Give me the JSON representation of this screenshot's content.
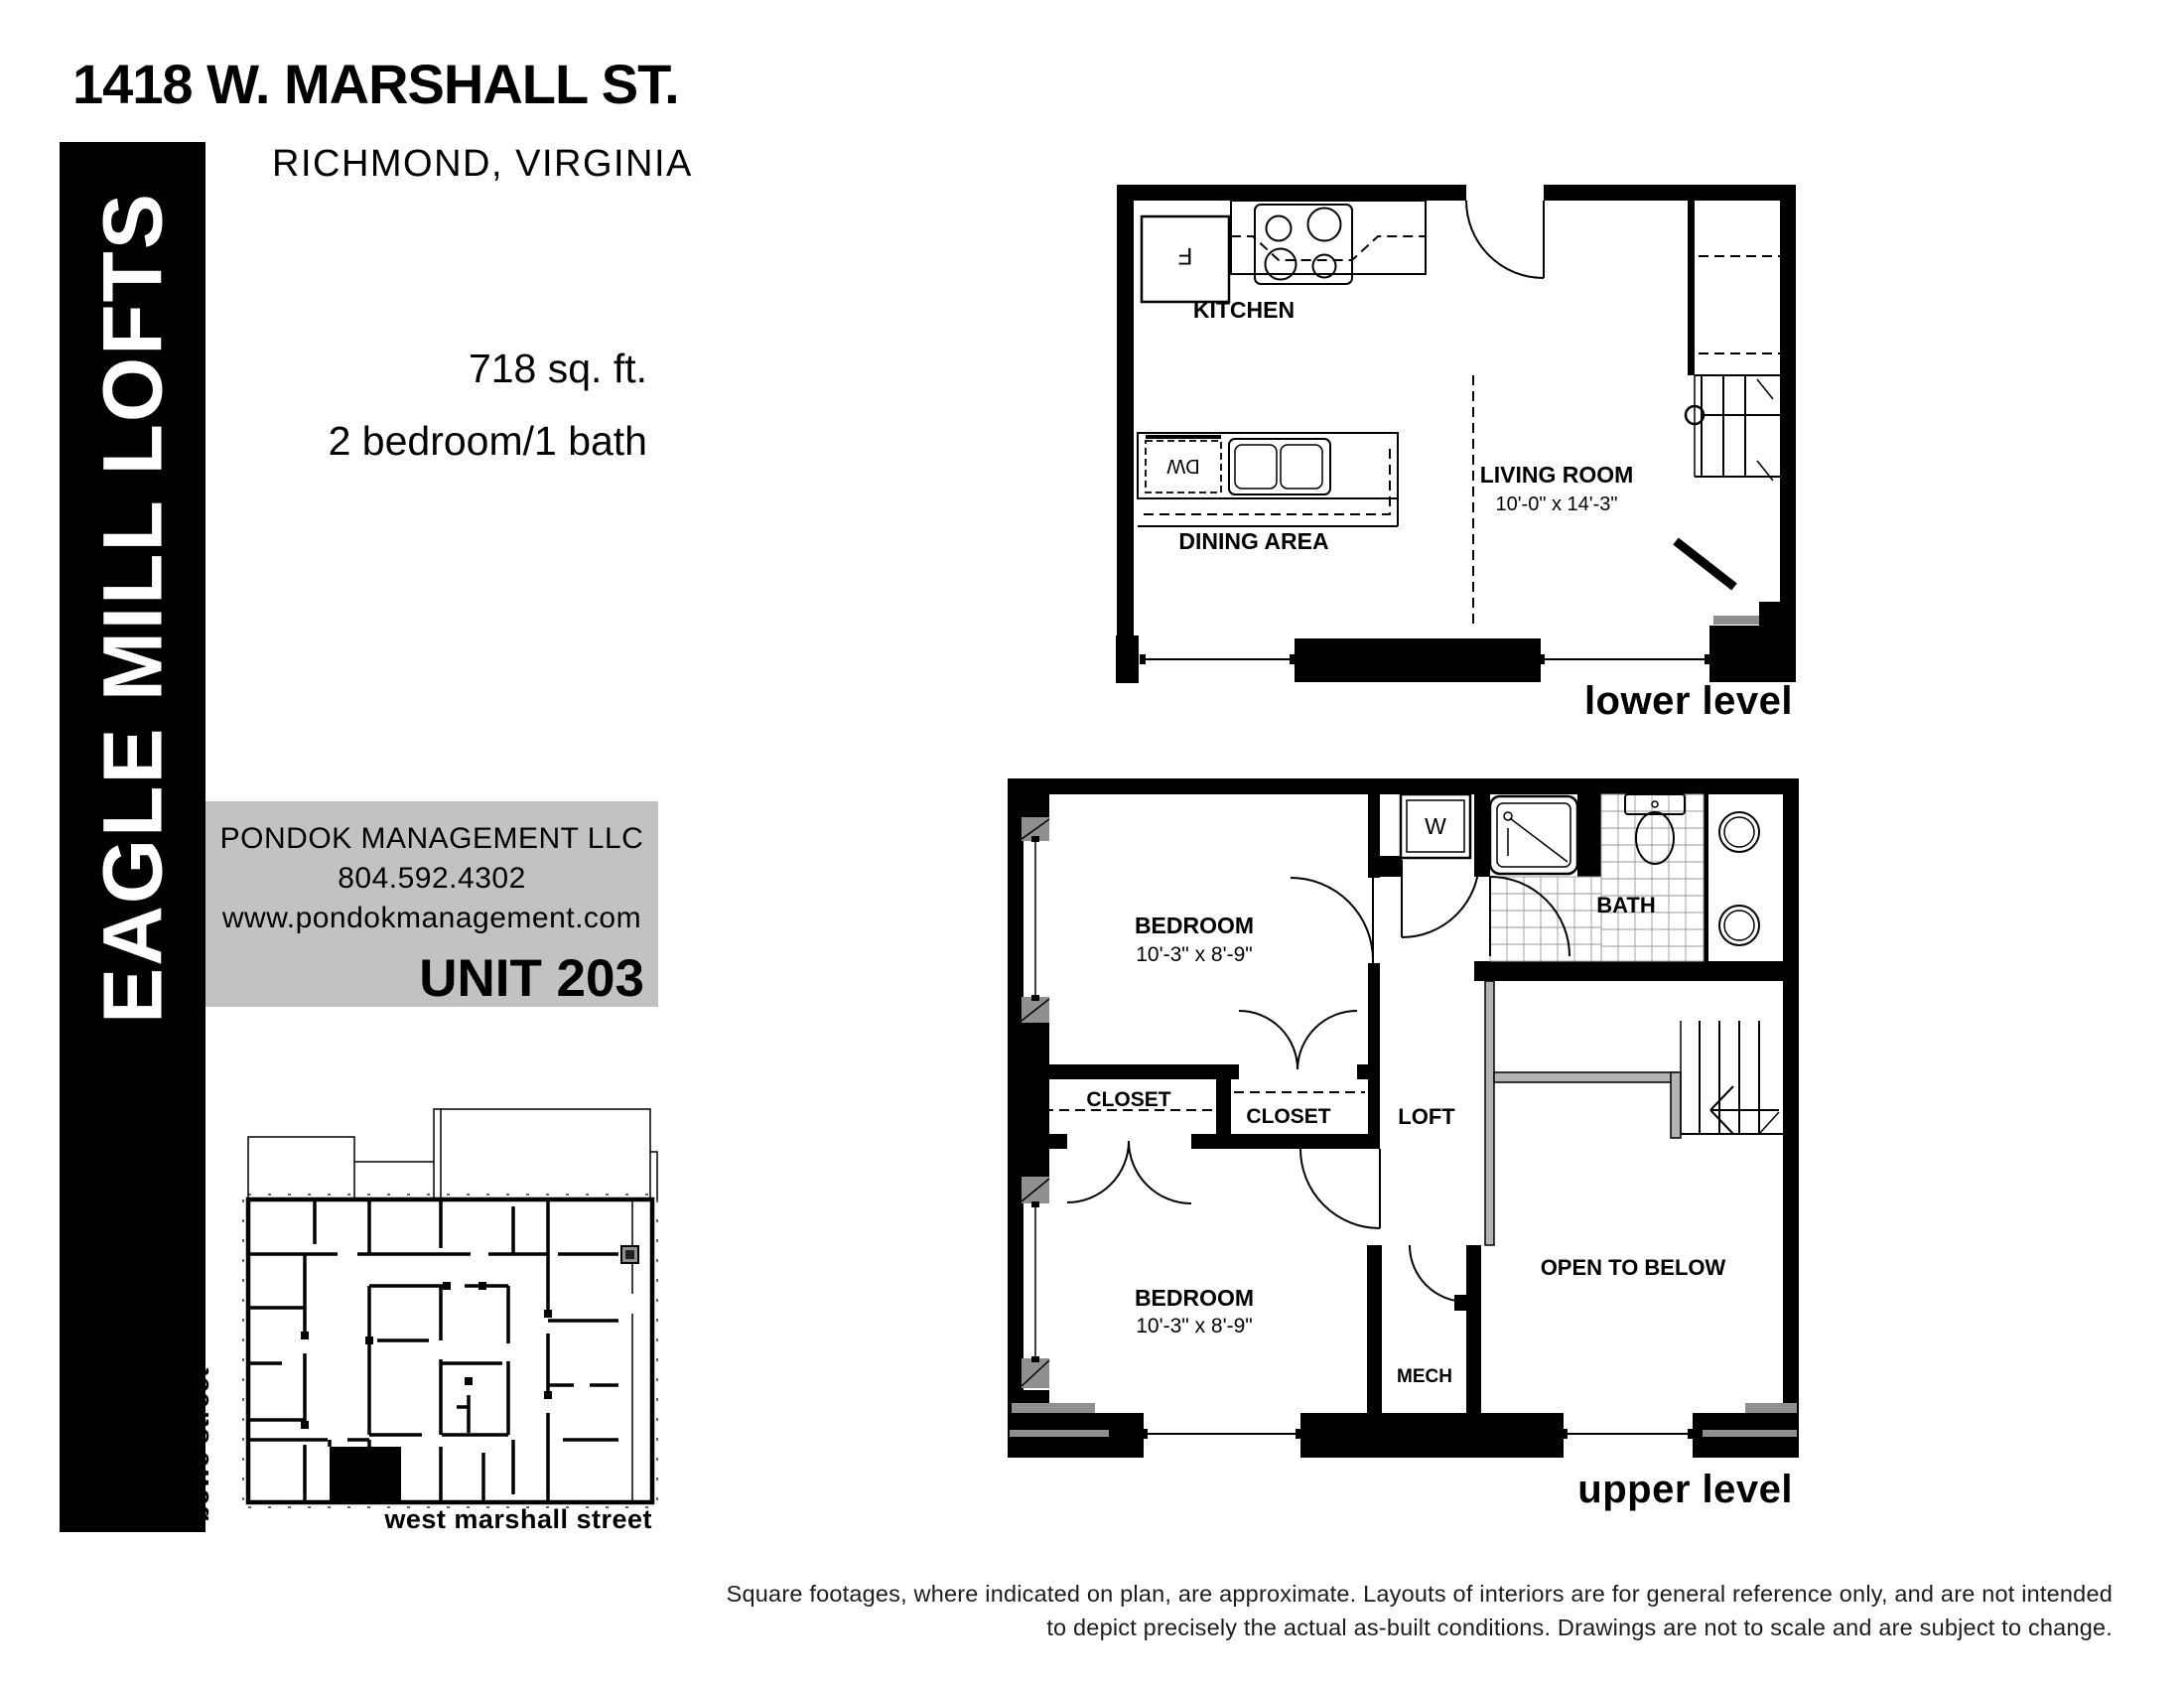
{
  "header": {
    "address": "1418 W. MARSHALL ST.",
    "city": "RICHMOND, VIRGINIA"
  },
  "banner": {
    "name": "EAGLE MILL LOFTS",
    "bg": "#000000",
    "fg": "#ffffff"
  },
  "unit_info": {
    "area": "718 sq. ft.",
    "layout": "2 bedroom/1 bath"
  },
  "management": {
    "company": "PONDOK MANAGEMENT LLC",
    "phone": "804.592.4302",
    "website": "www.pondokmanagement.com",
    "unit": "UNIT 203",
    "bg": "#c2c2c2"
  },
  "lower_level": {
    "caption": "lower level",
    "kitchen": "KITCHEN",
    "dining": "DINING AREA",
    "living": "LIVING ROOM",
    "living_dims": "10'-0\" x 14'-3\"",
    "fridge": "F",
    "dishwasher": "DW"
  },
  "upper_level": {
    "caption": "upper level",
    "bedroom": "BEDROOM",
    "bedroom_dims": "10'-3\" x 8'-9\"",
    "bath": "BATH",
    "closet": "CLOSET",
    "loft": "LOFT",
    "mech": "MECH",
    "open_below": "OPEN TO BELOW",
    "washer": "W"
  },
  "site_plan": {
    "street_west": "bowe street",
    "street_south": "west marshall street"
  },
  "disclaimer": {
    "line1": "Square footages, where indicated on plan, are approximate.  Layouts of interiors are for general reference only, and are not intended",
    "line2": "to depict precisely the actual as-built conditions.  Drawings are not to scale and are subject to change."
  }
}
